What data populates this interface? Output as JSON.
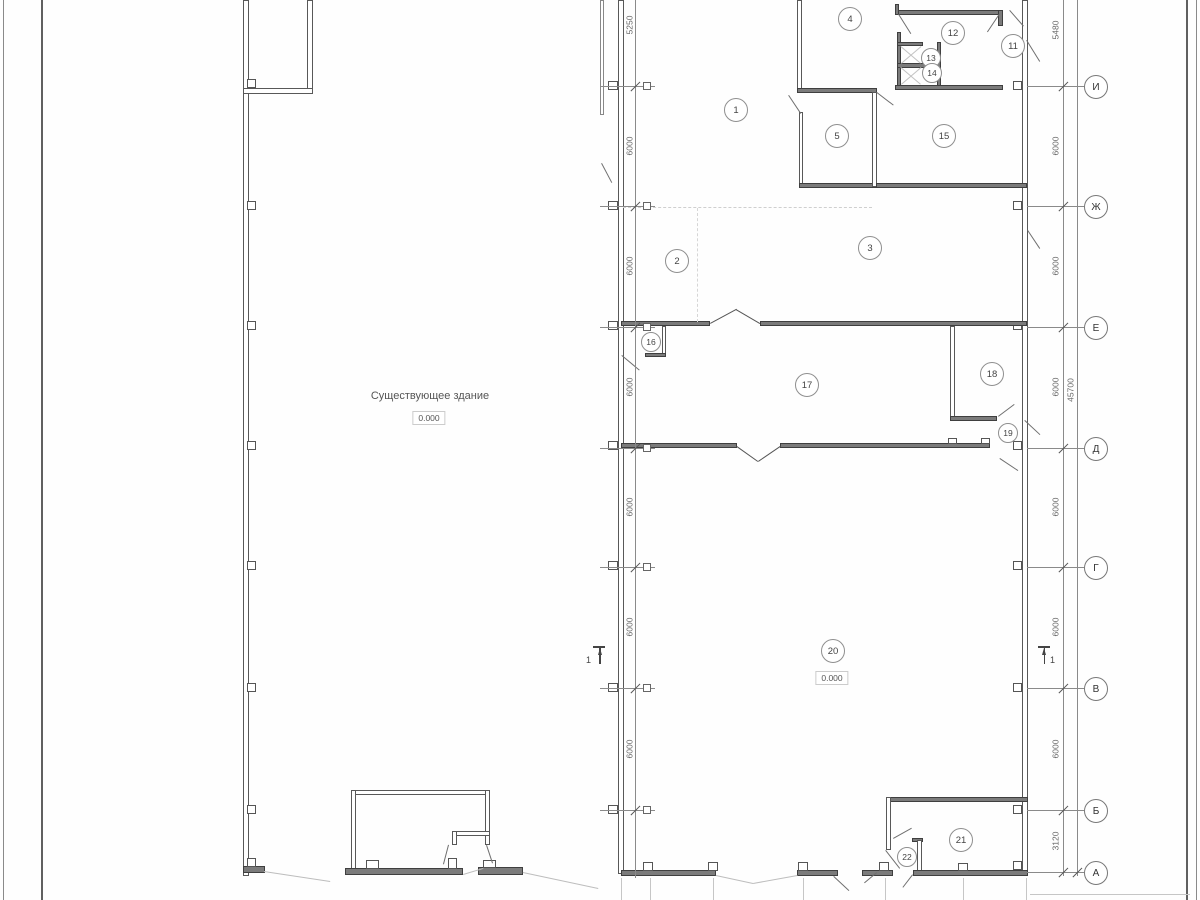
{
  "drawing": {
    "existing_building_label": "Существующее здание",
    "existing_building_level": "0.000",
    "hall_level": "0.000",
    "section_mark_label": "1"
  },
  "rooms": [
    "1",
    "2",
    "3",
    "4",
    "5",
    "11",
    "12",
    "13",
    "14",
    "15",
    "16",
    "17",
    "18",
    "19",
    "20",
    "21",
    "22"
  ],
  "axes": [
    "И",
    "Ж",
    "Е",
    "Д",
    "Г",
    "В",
    "Б",
    "А"
  ],
  "dims_left": [
    "5250",
    "6000",
    "6000",
    "6000",
    "6000",
    "6000",
    "6000"
  ],
  "dims_right": [
    "5480",
    "6000",
    "6000",
    "6000",
    "6000",
    "6000",
    "6000",
    "3120"
  ],
  "dim_overall": "45700"
}
